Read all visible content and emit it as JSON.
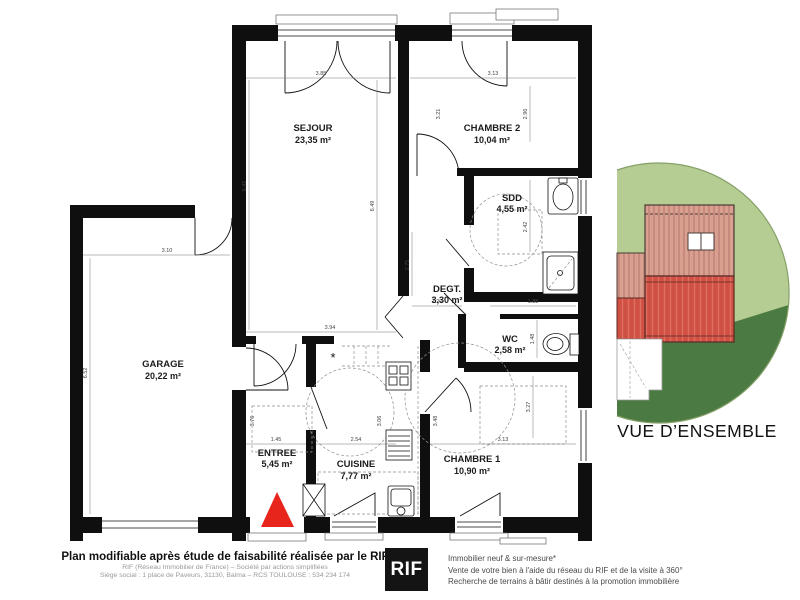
{
  "plan": {
    "rooms": [
      {
        "name": "SEJOUR",
        "area": "23,35 m²"
      },
      {
        "name": "CHAMBRE 2",
        "area": "10,04 m²"
      },
      {
        "name": "SDD",
        "area": "4,55 m²"
      },
      {
        "name": "DEGT.",
        "area": "3,30 m²"
      },
      {
        "name": "WC",
        "area": "2,58 m²"
      },
      {
        "name": "GARAGE",
        "area": "20,22 m²"
      },
      {
        "name": "ENTREE",
        "area": "5,45 m²"
      },
      {
        "name": "CUISINE",
        "area": "7,77 m²"
      },
      {
        "name": "CHAMBRE 1",
        "area": "10,90 m²"
      }
    ],
    "dimensions": [
      {
        "v": "3.85"
      },
      {
        "v": "3.13"
      },
      {
        "v": "6.41"
      },
      {
        "v": "6.49"
      },
      {
        "v": "3.10"
      },
      {
        "v": "6.52"
      },
      {
        "v": "2.96"
      },
      {
        "v": "3.21"
      },
      {
        "v": "2.42"
      },
      {
        "v": "2.75"
      },
      {
        "v": "1.20"
      },
      {
        "v": "1.88"
      },
      {
        "v": "1.48"
      },
      {
        "v": "3.94"
      },
      {
        "v": "1.45"
      },
      {
        "v": "2.54"
      },
      {
        "v": "3.13"
      },
      {
        "v": "3.27"
      },
      {
        "v": "3.06"
      },
      {
        "v": "3.48"
      },
      {
        "v": "3.76"
      }
    ],
    "note_star": "*"
  },
  "inset": {
    "caption": "VUE D’ENSEMBLE"
  },
  "footer": {
    "left_title": "Plan modifiable après étude de faisabilité réalisée par le RIF",
    "left_line2": "RIF (Réseau Immobilier de France) – Société par actions simplifiées",
    "left_line3": "Siège social : 1 place de Paveurs, 31130, Balma – RCS TOULOUSE : 534 234 174",
    "logo_text": "RIF",
    "right_line1": "Immobilier neuf & sur-mesure*",
    "right_line2": "Vente de votre bien à l'aide du réseau du RIF et de la visite à 360°",
    "right_line3": "Recherche de terrains à bâtir destinés à la promotion immobilière"
  },
  "colors": {
    "entrance_red": "#e8251d",
    "inset_light_green": "#b5cd92",
    "inset_dark_green": "#4b7b43",
    "inset_outline_green": "#86a068",
    "roof_pink": "#d9a090",
    "roof_pink_stripe": "#c2857a",
    "roof_red": "#d05044",
    "roof_red_stripe": "#de6f61"
  }
}
